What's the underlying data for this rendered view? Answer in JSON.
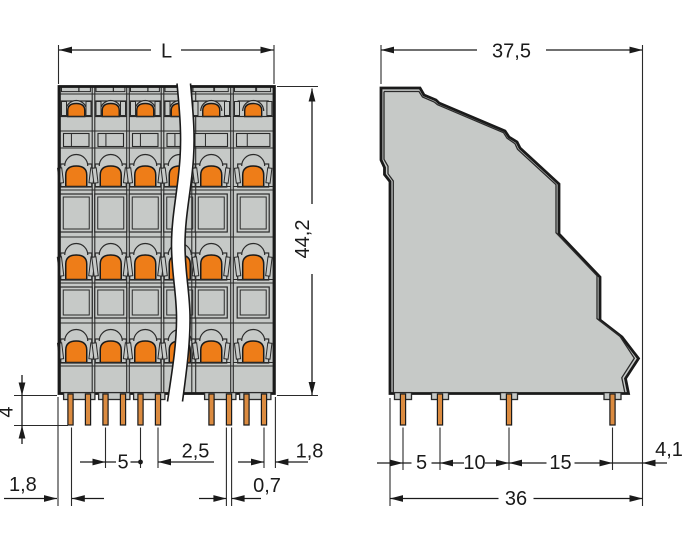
{
  "drawing": {
    "type": "technical dimension drawing",
    "front_view": {
      "pole_columns_visible": 6,
      "clamp_levels": 4,
      "solder_pins_left_group": 6,
      "solder_pins_right_group": 4,
      "dims": {
        "length": "L",
        "height": "44,2",
        "pin_length": "4",
        "edge_to_first_pin": "1,8",
        "pole_pitch": "5",
        "pin_spacing": "2,5",
        "pin_width": "0,7",
        "last_pin_to_edge": "1,8"
      }
    },
    "side_view": {
      "solder_pins": 4,
      "dims": {
        "depth": "37,5",
        "pin_offset_1": "5",
        "pin_offset_2": "10",
        "pin_offset_3": "15",
        "mounting_depth": "36",
        "rear_offset": "4,1"
      }
    },
    "colors": {
      "housing_gray": "#c6c9c7",
      "actuator_orange": "#ee7d18",
      "pin_copper": "#db8b40",
      "line_black": "#1a1a1a"
    }
  }
}
